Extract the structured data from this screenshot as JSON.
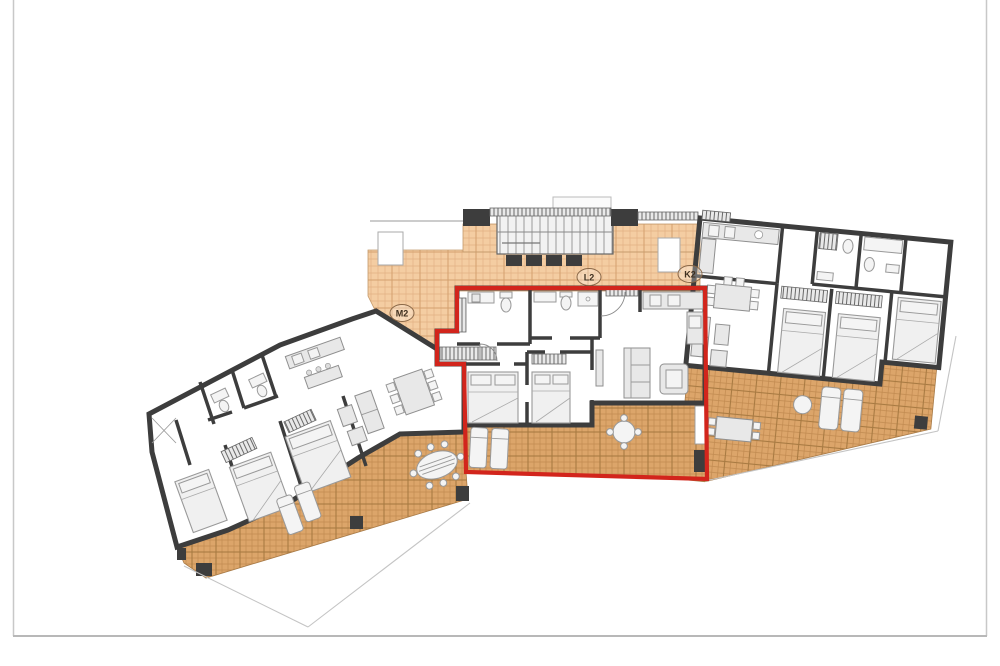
{
  "page": {
    "background": "#ffffff",
    "frame_color": "#c8c8c8",
    "content": "architectural floor plan, three apartment units, middle unit highlighted"
  },
  "plan": {
    "colors": {
      "room": "#f8f5cd",
      "terrace": "#dca56a",
      "walkway": "#f4cda2",
      "wall": "#3d3d3d",
      "furniture": "#e8e8e8",
      "highlight": "#d2251c",
      "frame": "#c8c8c8"
    },
    "units": [
      {
        "id": "left",
        "label": "M2",
        "highlighted": false
      },
      {
        "id": "middle",
        "label": "L2",
        "highlighted": true,
        "highlight_color": "#d2251c"
      },
      {
        "id": "right",
        "label": "K2",
        "highlighted": false
      }
    ]
  }
}
